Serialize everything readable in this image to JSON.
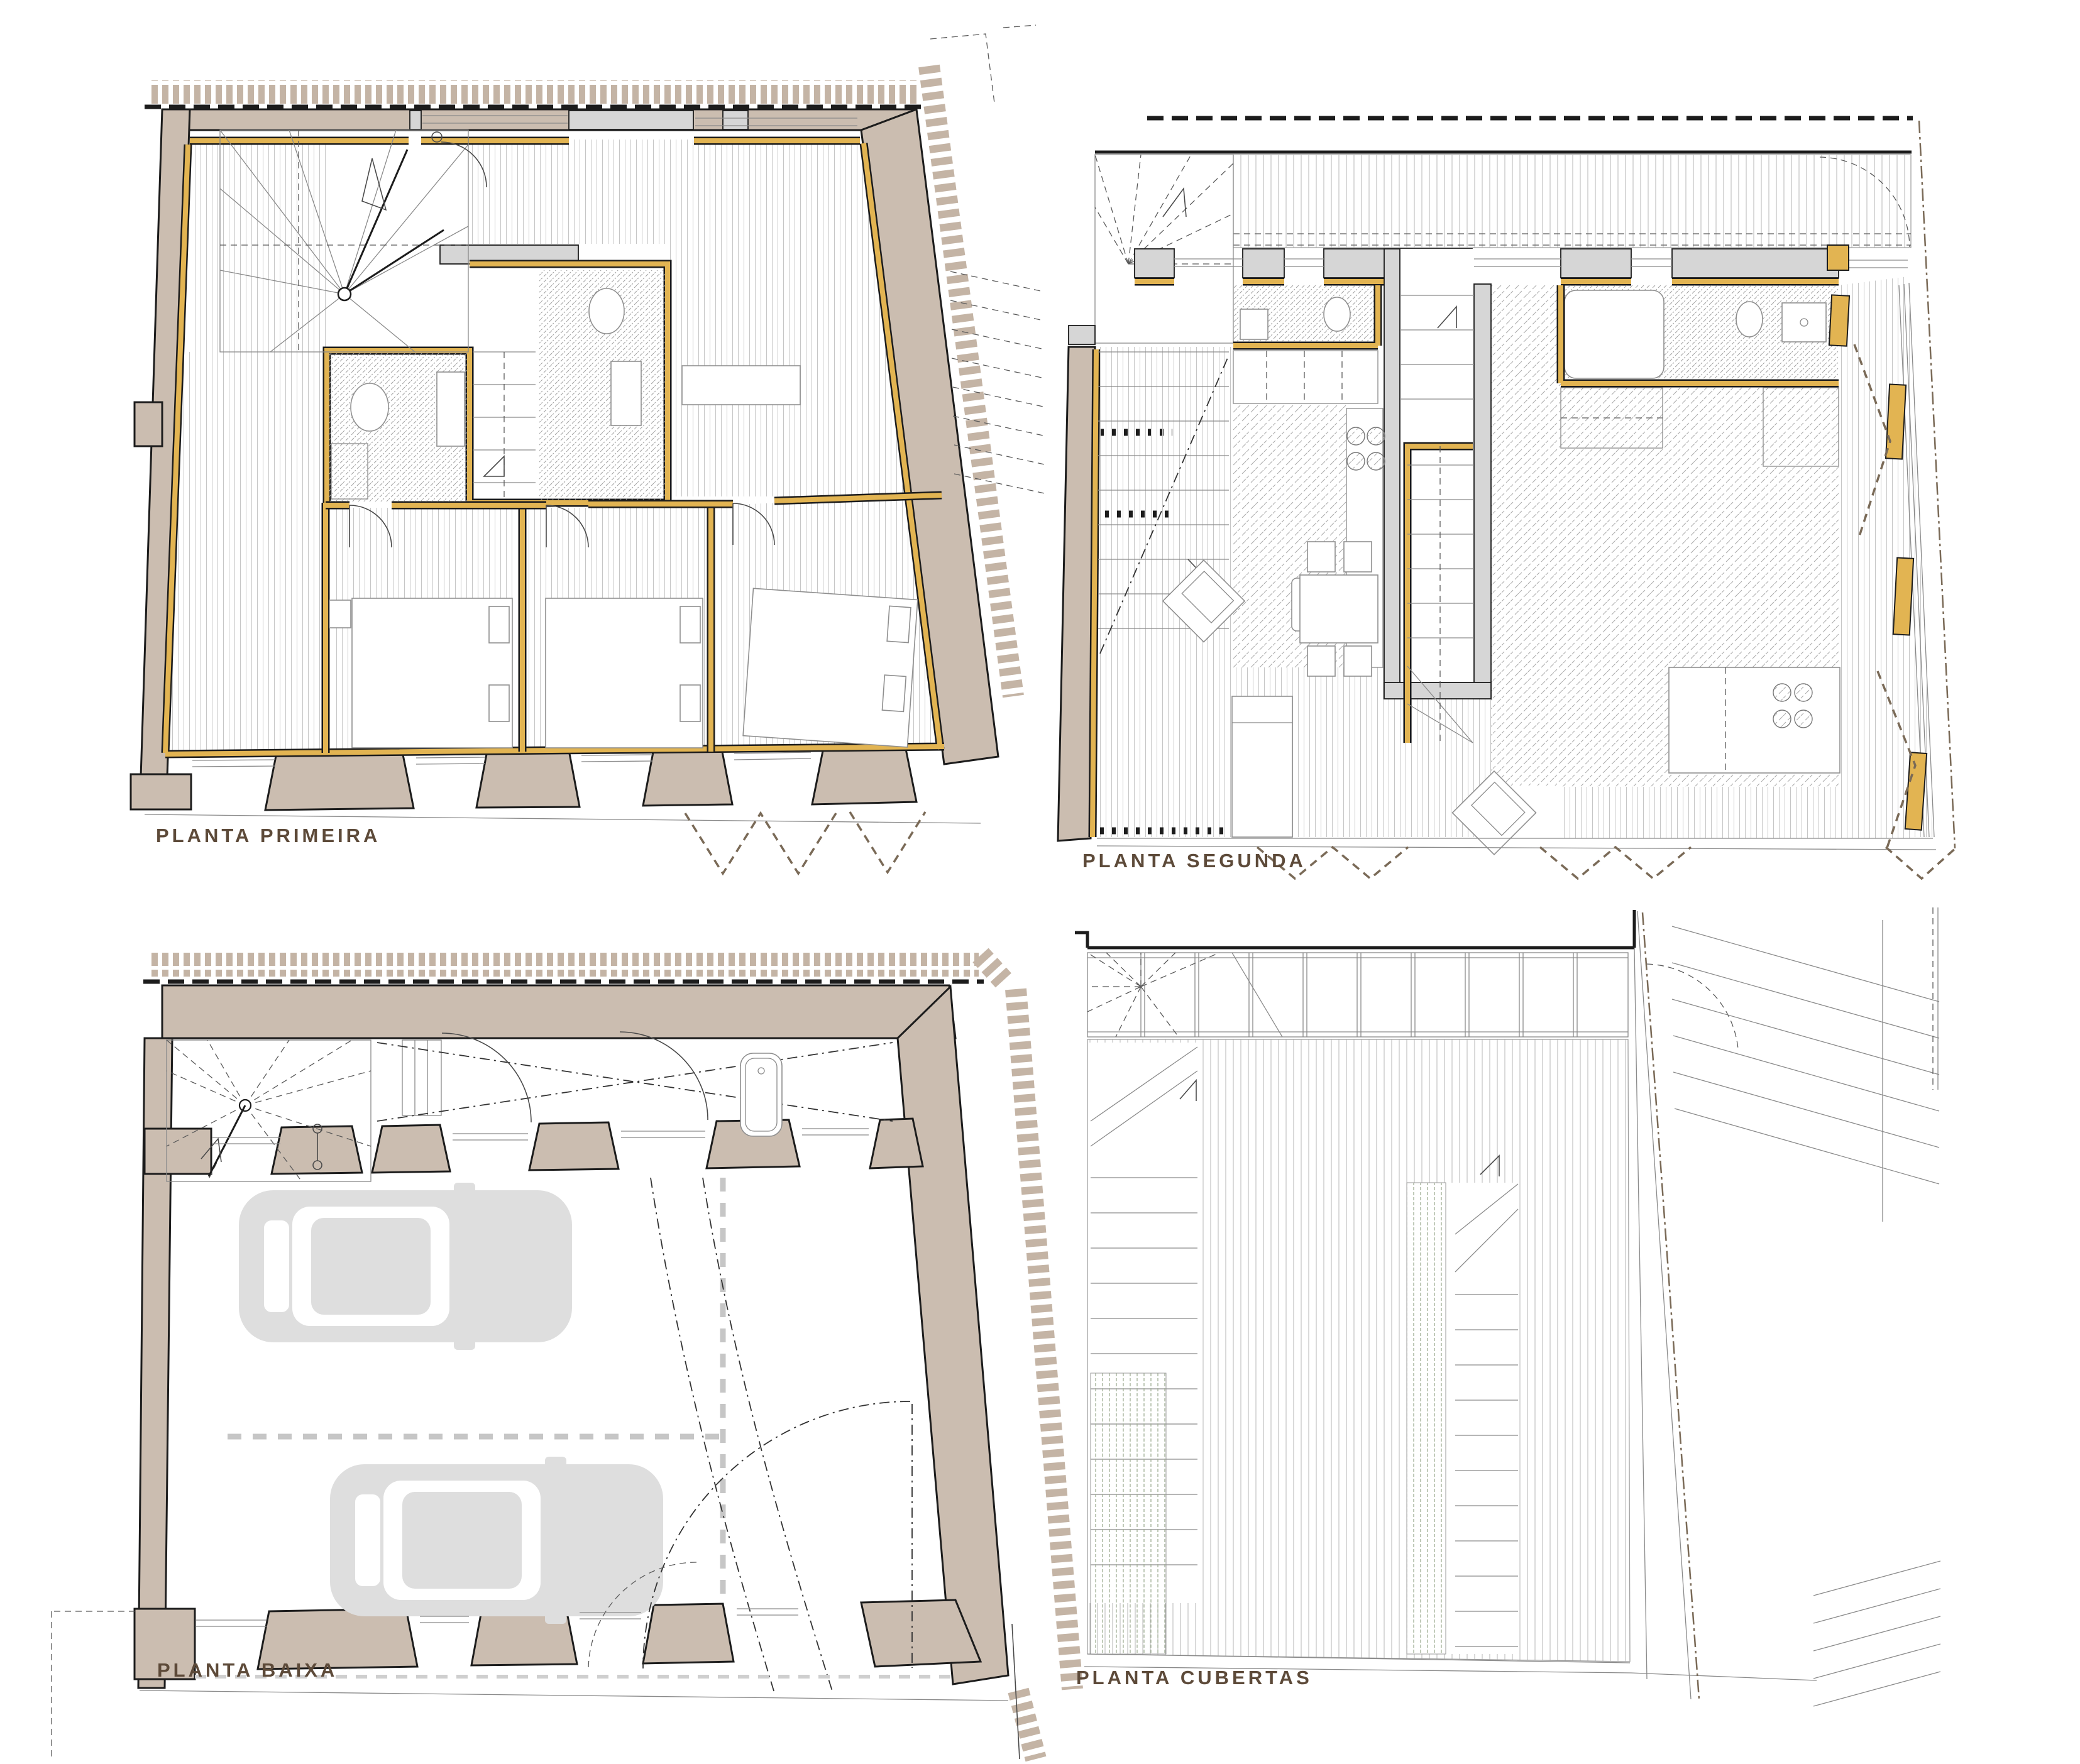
{
  "sheet": {
    "background": "#ffffff",
    "kind": "architectural floor plan sheet",
    "plan_count": 4
  },
  "plans": [
    {
      "id": "planta-primeira",
      "label": "PLANTA PRIMEIRA"
    },
    {
      "id": "planta-segunda",
      "label": "PLANTA SEGUNDA"
    },
    {
      "id": "planta-baixa",
      "label": "PLANTA BAIXA"
    },
    {
      "id": "planta-cubertas",
      "label": "PLANTA CUBERTAS"
    }
  ],
  "palette": {
    "wall": "#cbbdb0",
    "party": "#c4b4a5",
    "gold": "#e2b452",
    "gray": "#d6d6d6",
    "car": "#dedede",
    "green": "#9fae93",
    "brown": "#7a6a57",
    "label": "#5d4a39",
    "ink": "#1c1c1c"
  }
}
